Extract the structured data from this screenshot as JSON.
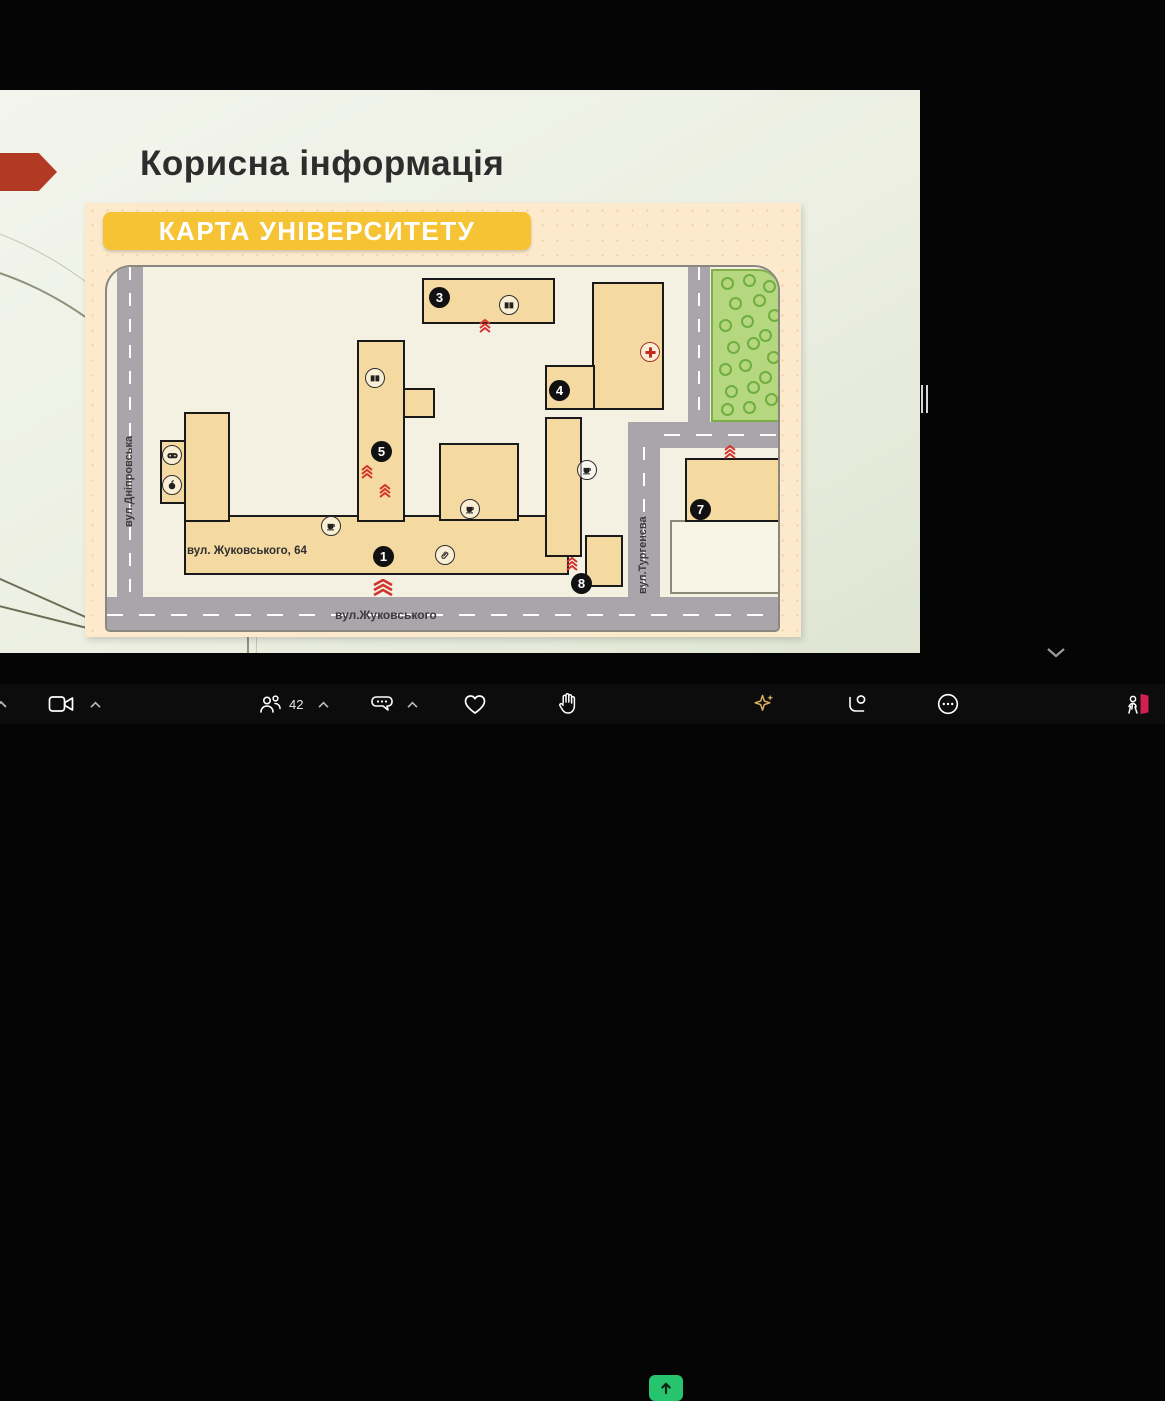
{
  "slide": {
    "title": "Корисна інформація",
    "banner": "КАРТА УНІВЕРСИТЕТУ",
    "map": {
      "streets": {
        "left": "вул.Дніпровська",
        "bottom": "вул.Жуковського",
        "right": "вул.Тургенєва"
      },
      "address_label": "вул. Жуковського, 64",
      "markers": {
        "b1": "1",
        "b3": "3",
        "b4": "4",
        "b5": "5",
        "b7": "7",
        "b8": "8"
      },
      "icons": [
        "book",
        "coffee",
        "paperclip",
        "gamepad",
        "apple",
        "medical-cross",
        "entrance-chevrons"
      ],
      "colors": {
        "building_tan": "#f4d9a1",
        "road_gray": "#a9a5ab",
        "park_green": "#b5d77f",
        "campus_cream": "#f4f0e2",
        "entrance_red": "#d0342c"
      }
    },
    "colors": {
      "arrow_red": "#b23a25",
      "banner_yellow": "#f5c333",
      "panel_peach": "#fdeacd"
    }
  },
  "participants_panel": {
    "tiles": [
      {
        "name": "Олексій Кузькін",
        "muted": false,
        "active_speaker": true
      },
      {
        "name": "Сергій ТУРПАК",
        "muted": true,
        "active_speaker": false
      },
      {
        "name": "Алла Каплуновська",
        "muted": false,
        "active_speaker": false
      },
      {
        "name": "Вадим Кубіч",
        "muted": true,
        "active_speaker": false
      },
      {
        "name": "Олександр Тарасенко",
        "muted": false,
        "active_speaker": false
      },
      {
        "name": "Ольга Дударенко",
        "muted": true,
        "active_speaker": false
      },
      {
        "name": "Олександр Артюх",
        "muted": false,
        "active_speaker": false
      }
    ],
    "active_border_color": "#2fe08d",
    "mute_red": "#e04b4b"
  },
  "toolbar": {
    "participants_count": "42",
    "icons": [
      "video-camera",
      "participants",
      "chat",
      "heart-reaction",
      "raise-hand",
      "share-screen",
      "ai-sparkle",
      "apps",
      "more",
      "leave-meeting"
    ],
    "share_green": "#27c46e",
    "leave_red": "#d11f50",
    "sparkle_gold": "#d8b05e"
  }
}
